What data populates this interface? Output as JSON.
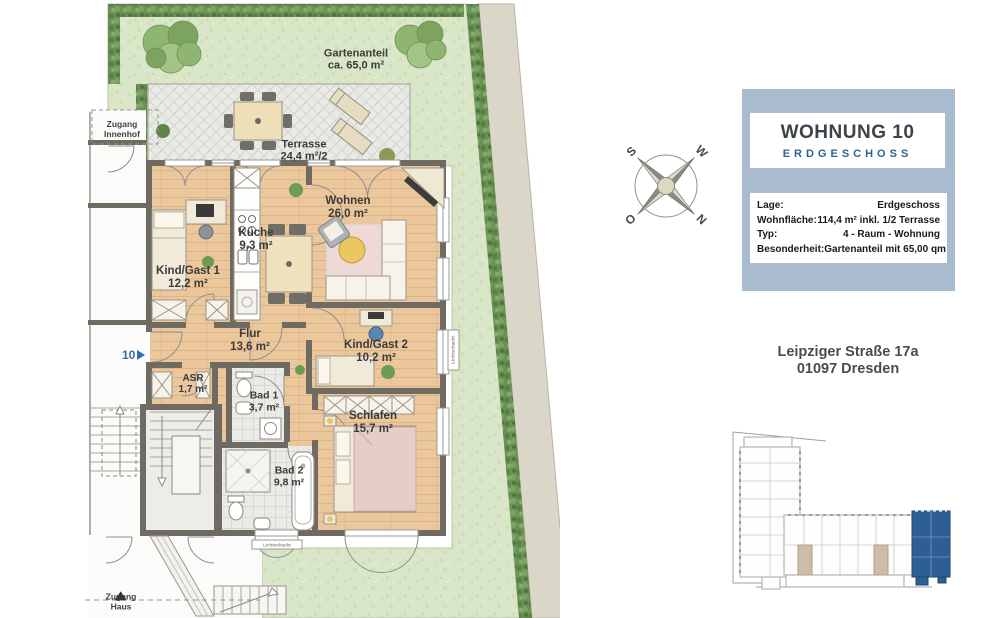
{
  "plan": {
    "garden": {
      "line1": "Gartenanteil",
      "line2": "ca. 65,0 m²"
    },
    "rooms": {
      "terrasse": {
        "name": "Terrasse",
        "area": "24,4 m²/2"
      },
      "wohnen": {
        "name": "Wohnen",
        "area": "26,0 m²"
      },
      "kueche": {
        "name": "Küche",
        "area": "9,3 m²"
      },
      "kind1": {
        "name": "Kind/Gast 1",
        "area": "12,2 m²"
      },
      "flur": {
        "name": "Flur",
        "area": "13,6 m²"
      },
      "kind2": {
        "name": "Kind/Gast 2",
        "area": "10,2 m²"
      },
      "asr": {
        "name": "ASR",
        "area": "1,7 m²"
      },
      "bad1": {
        "name": "Bad 1",
        "area": "3,7 m²"
      },
      "schlafen": {
        "name": "Schlafen",
        "area": "15,7 m²"
      },
      "bad2": {
        "name": "Bad 2",
        "area": "9,8 m²"
      }
    },
    "access_innenhof": {
      "line1": "Zugang",
      "line2": "Innenhof"
    },
    "access_haus": {
      "line1": "Zugang",
      "line2": "Haus"
    },
    "unit_number": "10",
    "lichtschacht": "Lichtschacht"
  },
  "compass": {
    "n": "N",
    "e": "O",
    "s": "S",
    "w": "W"
  },
  "info_box": {
    "title": "WOHNUNG 10",
    "subtitle": "ERDGESCHOSS",
    "rows": [
      {
        "label": "Lage:",
        "value": "Erdgeschoss"
      },
      {
        "label": "Wohnfläche:",
        "value": "114,4 m² inkl. 1/2 Terrasse"
      },
      {
        "label": "Typ:",
        "value": "4 - Raum - Wohnung"
      },
      {
        "label": "Besonderheit:",
        "value": "Gartenanteil mit 65,00 qm"
      }
    ]
  },
  "address": {
    "line1": "Leipziger Straße 17a",
    "line2": "01097 Dresden"
  },
  "colors": {
    "panel_blue": "#a9bccf",
    "accent_blue": "#2d6494",
    "unit_highlight": "#2e5f94",
    "wall": "#6f6a62",
    "wood_floor": "#ebc89c",
    "grass": "#d9e6c7",
    "hedge": "#6b9254",
    "terrace": "#e9e9e5"
  }
}
